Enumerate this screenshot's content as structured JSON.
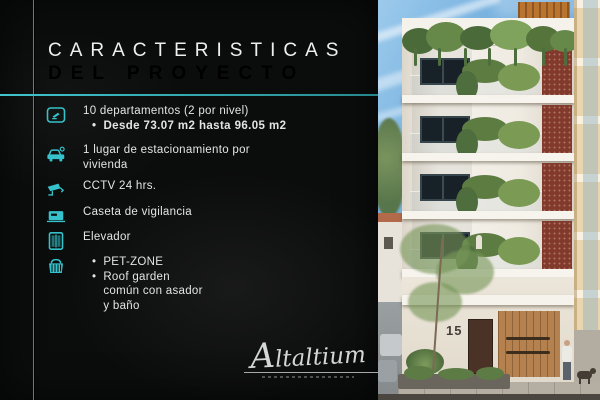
{
  "colors": {
    "accent": "#35c2ca",
    "panel_background": "#0b0c0c",
    "title_color": "#eef0f0",
    "body_text_color": "#e4e4e4"
  },
  "panel": {
    "title_line1": "CARACTERISTICAS",
    "title_line2": "DEL PROYECTO",
    "features": [
      {
        "icon": "floor-plan-icon",
        "lines": [
          "10 departamentos (2 por nivel)"
        ],
        "bullets": [
          {
            "bold": true,
            "text_lines": [
              "Desde 73.07 m2 hasta 96.05 m2"
            ]
          }
        ]
      },
      {
        "icon": "car-icon",
        "lines": [
          "1 lugar de estacionamiento por",
          "vivienda"
        ]
      },
      {
        "icon": "cctv-icon",
        "lines": [
          "CCTV 24 hrs."
        ]
      },
      {
        "icon": "guard-booth-icon",
        "lines": [
          "Caseta de vigilancia"
        ]
      },
      {
        "icon": "elevator-icon",
        "lines": [
          "Elevador"
        ]
      },
      {
        "icon": "pet-zone-icon",
        "bullets": [
          {
            "bold": false,
            "text_lines": [
              "PET-ZONE"
            ]
          },
          {
            "bold": false,
            "text_lines": [
              "Roof garden",
              "común con asador",
              "y baño"
            ]
          }
        ]
      }
    ],
    "logo_text": "Altaltium"
  },
  "photo": {
    "house_number": "15"
  }
}
